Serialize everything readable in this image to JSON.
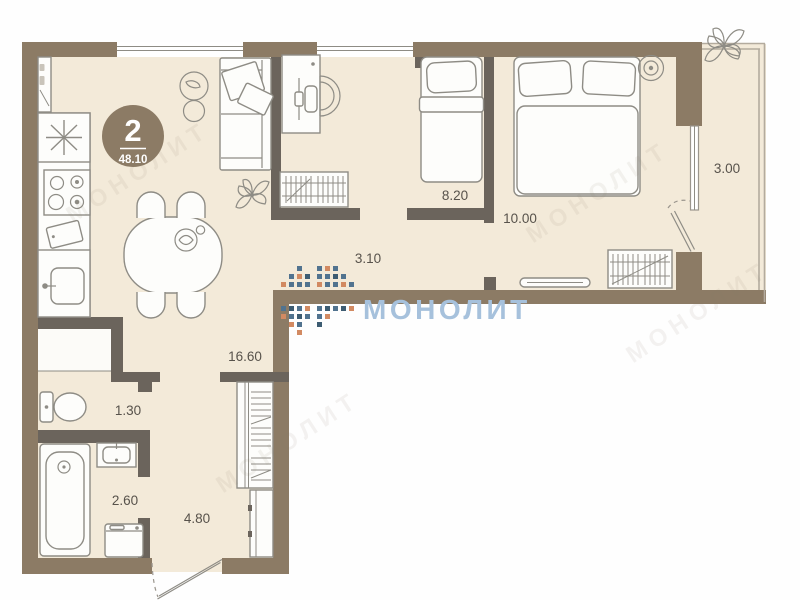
{
  "badge": {
    "rooms": "2",
    "total_area": "48.10"
  },
  "areas": {
    "living_kitchen": "16.60",
    "bedroom_small": "8.20",
    "bedroom_master": "10.00",
    "balcony": "3.00",
    "corridor": "3.10",
    "wc": "1.30",
    "bathroom": "2.60",
    "hallway": "4.80"
  },
  "brand": {
    "name": "МОНОЛИТ"
  },
  "watermark": {
    "text": "МОНОЛИТ"
  },
  "icons": {
    "vent": "eight-point-asterisk",
    "plant": "leaf-cluster",
    "ceiling_lamp": "concentric-circles"
  },
  "colors": {
    "wall_exterior": "#8c7b65",
    "wall_interior": "#6b645c",
    "floor": "#f3ead9",
    "outline": "#8e8c85",
    "label": "#57524b",
    "brand_text": "#a6c1dc",
    "sq_blue": "#51738f",
    "sq_dark": "#3d5c72",
    "sq_orange": "#d28a62",
    "badge_fill": "#8c7b65",
    "badge_text": "#ffffff"
  }
}
